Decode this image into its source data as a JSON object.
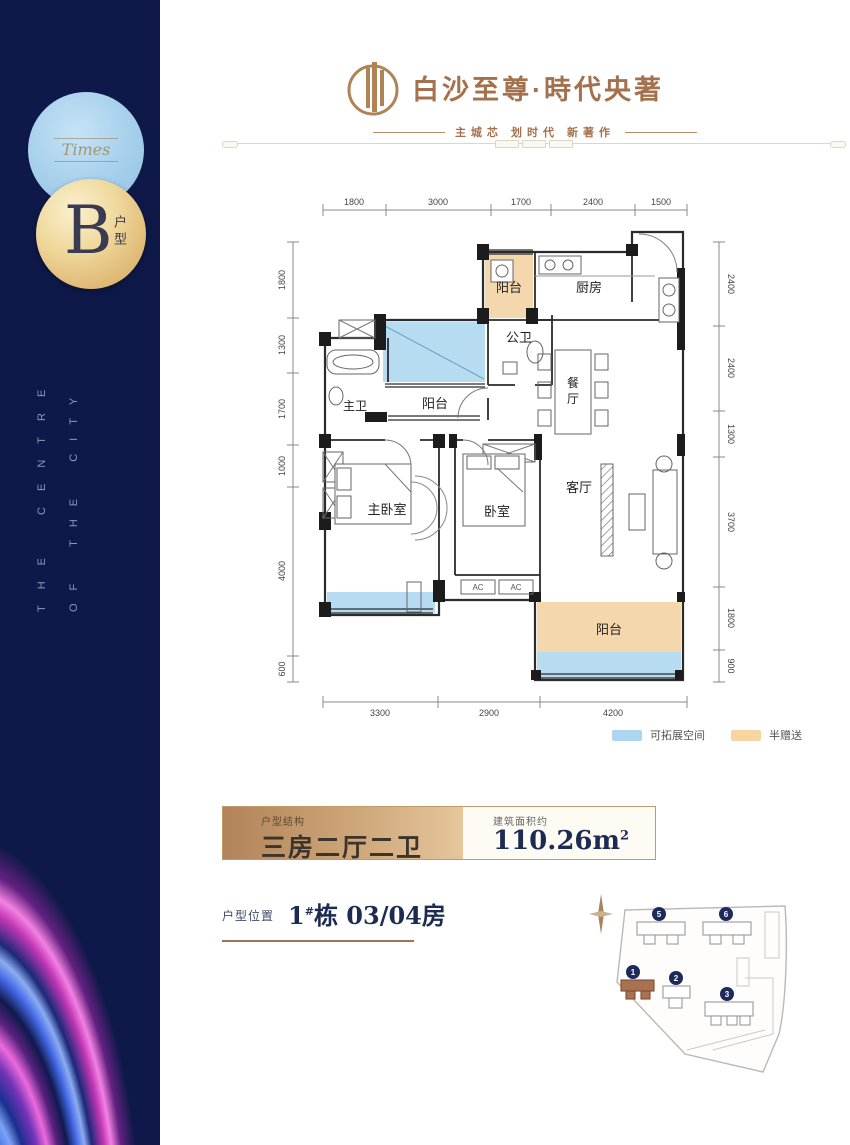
{
  "sidebar": {
    "script_word": "Times",
    "badge_letter": "B",
    "badge_caption": "户型",
    "vertical_left": "THE CENTRE",
    "vertical_right": "OF THE CITY"
  },
  "header": {
    "title": "白沙至尊·時代央著",
    "tagline": "主城芯 划时代 新著作"
  },
  "floorplan": {
    "dims_top": [
      "1800",
      "3000",
      "1700",
      "2400",
      "1500"
    ],
    "dims_left": [
      "1800",
      "1300",
      "1700",
      "1000",
      "4000",
      "600"
    ],
    "dims_right": [
      "2400",
      "2400",
      "1300",
      "3700",
      "1800",
      "900"
    ],
    "dims_bottom": [
      "3300",
      "2900",
      "4200"
    ],
    "rooms": {
      "balcony_top": "阳台",
      "kitchen": "厨房",
      "public_bath": "公卫",
      "dining_1": "餐",
      "dining_2": "厅",
      "master_bath": "主卫",
      "balcony_mid": "阳台",
      "master_bedroom": "主卧室",
      "bedroom": "卧室",
      "living": "客厅",
      "balcony_bottom": "阳台"
    },
    "ac": "AC",
    "legend": [
      {
        "label": "可拓展空间",
        "color": "#aed6f0"
      },
      {
        "label": "半赠送",
        "color": "#f6d5a2"
      }
    ]
  },
  "info": {
    "structure_label": "户型结构",
    "structure_value": "三房二厅二卫",
    "area_label": "建筑面积约",
    "area_value": "110.26m",
    "area_sup": "2",
    "position_label": "户型位置",
    "position_main": "1",
    "position_sup": "#",
    "position_rest": "栋 03/04房"
  },
  "sitemap": {
    "buildings": [
      {
        "num": "5"
      },
      {
        "num": "6"
      },
      {
        "num": "1"
      },
      {
        "num": "2"
      },
      {
        "num": "3"
      }
    ],
    "highlight_building": "1"
  },
  "colors": {
    "sidebar_navy": "#0f1949",
    "bronze": "#a4714e",
    "gold_bar": "#c29a66",
    "navy_text": "#1c2b52",
    "expand_blue": "#aed6f0",
    "gift_tan": "#f6d5a2",
    "aurora_pink": "#f86ee6",
    "aurora_blue": "#2250cf"
  }
}
